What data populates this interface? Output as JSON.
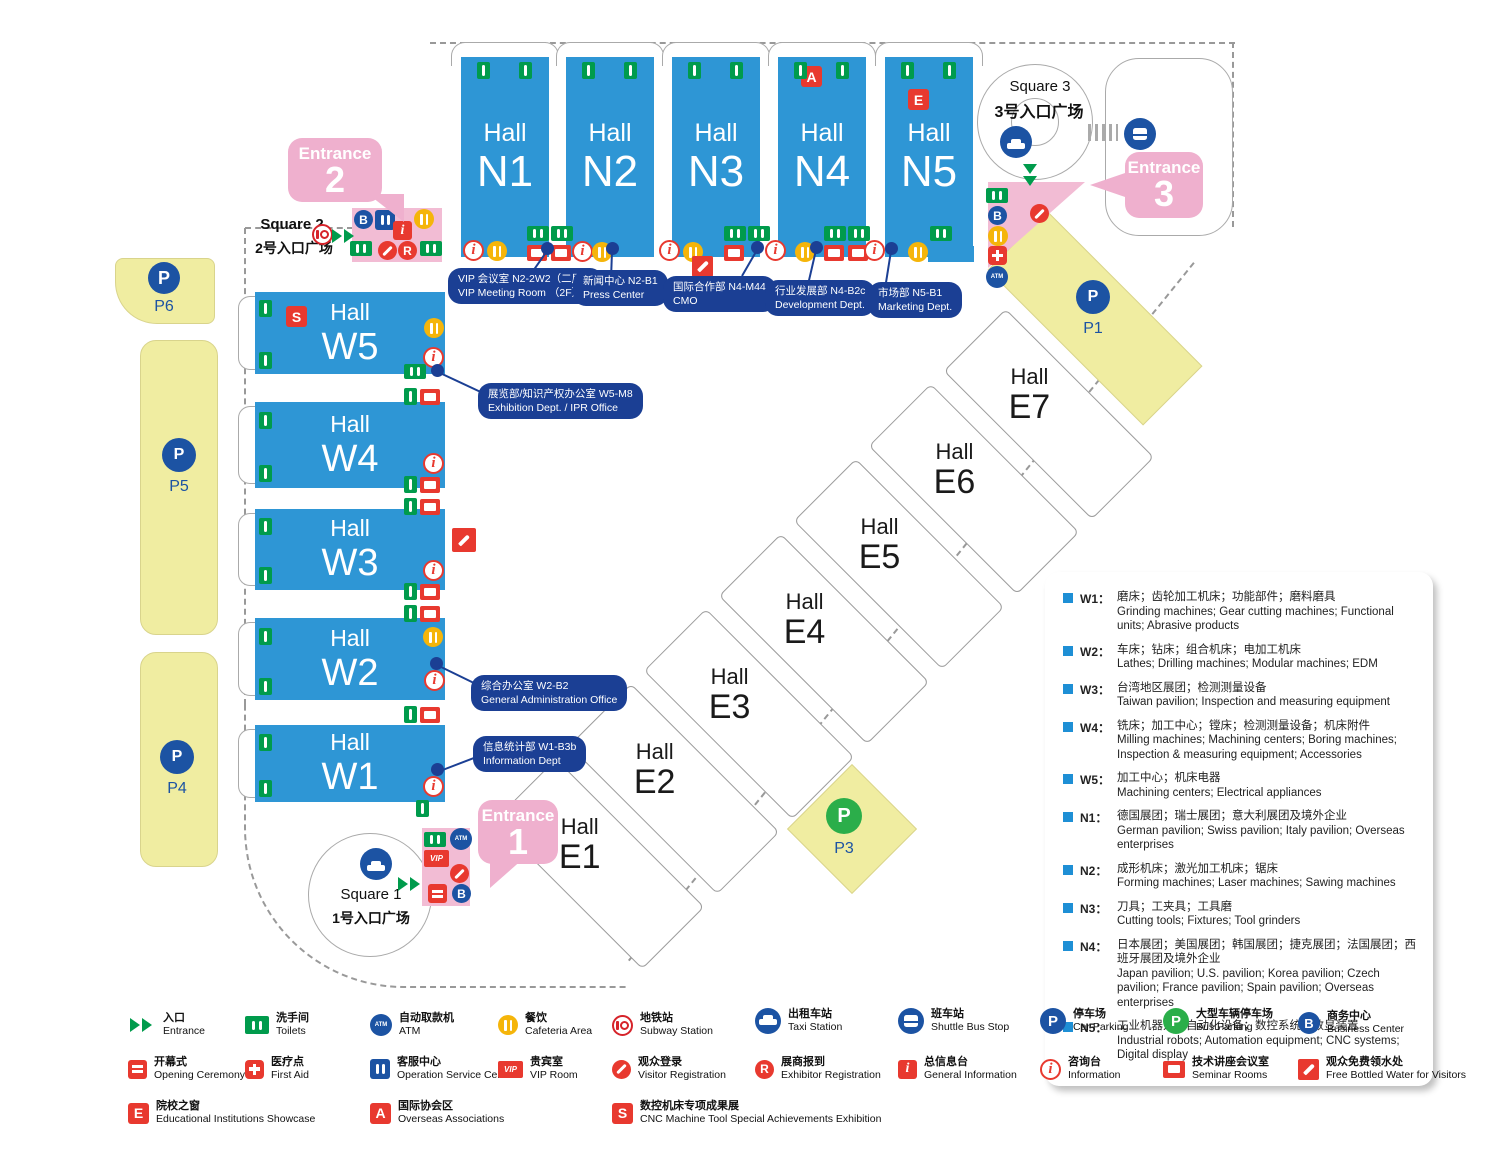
{
  "colors": {
    "hall_blue": "#2E96D5",
    "callout_navy": "#1B3F94",
    "parking_yellow": "#F0EDA1",
    "entrance_pink": "#F2BCD4",
    "accent_red": "#E8392F",
    "accent_green": "#009B4C"
  },
  "map": {
    "badges": {
      "p": "P",
      "b": "B",
      "r": "R",
      "i": "i",
      "vip": "VIP",
      "atm": "ATM",
      "e": "E",
      "a": "A",
      "s": "S"
    },
    "halls_n": [
      {
        "word": "Hall",
        "code": "N1"
      },
      {
        "word": "Hall",
        "code": "N2"
      },
      {
        "word": "Hall",
        "code": "N3"
      },
      {
        "word": "Hall",
        "code": "N4"
      },
      {
        "word": "Hall",
        "code": "N5"
      }
    ],
    "halls_w": [
      {
        "word": "Hall",
        "code": "W5"
      },
      {
        "word": "Hall",
        "code": "W4"
      },
      {
        "word": "Hall",
        "code": "W3"
      },
      {
        "word": "Hall",
        "code": "W2"
      },
      {
        "word": "Hall",
        "code": "W1"
      }
    ],
    "halls_e": [
      {
        "word": "Hall",
        "code": "E1"
      },
      {
        "word": "Hall",
        "code": "E2"
      },
      {
        "word": "Hall",
        "code": "E3"
      },
      {
        "word": "Hall",
        "code": "E4"
      },
      {
        "word": "Hall",
        "code": "E5"
      },
      {
        "word": "Hall",
        "code": "E6"
      },
      {
        "word": "Hall",
        "code": "E7"
      }
    ],
    "parking": {
      "p1": "P1",
      "p3": "P3",
      "p4": "P4",
      "p5": "P5",
      "p6": "P6"
    },
    "squares": {
      "s1": {
        "en": "Square 1",
        "zh": "1号入口广场"
      },
      "s2": {
        "en": "Square 2",
        "zh": "2号入口广场"
      },
      "s3": {
        "en": "Square 3",
        "zh": "3号入口广场"
      }
    },
    "entrances": {
      "e1": {
        "word": "Entrance",
        "num": "1"
      },
      "e2": {
        "word": "Entrance",
        "num": "2"
      },
      "e3": {
        "word": "Entrance",
        "num": "3"
      }
    },
    "callouts": {
      "vip": {
        "zh": "VIP 会议室  N2-2W2（二层）",
        "en": "VIP Meeting Room （2F）"
      },
      "press": {
        "zh": "新闻中心  N2-B1",
        "en": "Press Center"
      },
      "cmo": {
        "zh": "国际合作部  N4-M44",
        "en": "CMO"
      },
      "dev": {
        "zh": "行业发展部  N4-B2c",
        "en": "Development Dept."
      },
      "mkt": {
        "zh": "市场部  N5-B1",
        "en": "Marketing Dept."
      },
      "ipr": {
        "zh": "展览部/知识产权办公室  W5-M8",
        "en": "Exhibition Dept. / IPR Office"
      },
      "admin": {
        "zh": "综合办公室  W2-B2",
        "en": "General Administration Office"
      },
      "infodept": {
        "zh": "信息统计部  W1-B3b",
        "en": "Information Dept"
      }
    }
  },
  "legend_box": {
    "items": [
      {
        "code": "W1：",
        "zh": "磨床；齿轮加工机床；功能部件；磨料磨具",
        "en": "Grinding machines; Gear cutting machines; Functional units; Abrasive products"
      },
      {
        "code": "W2：",
        "zh": "车床；钻床；组合机床；电加工机床",
        "en": "Lathes; Drilling machines; Modular machines; EDM"
      },
      {
        "code": "W3：",
        "zh": "台湾地区展团；检测测量设备",
        "en": "Taiwan pavilion; Inspection and measuring equipment"
      },
      {
        "code": "W4：",
        "zh": "铣床；加工中心；镗床；检测测量设备；机床附件",
        "en": "Milling machines; Machining centers; Boring machines; Inspection & measuring equipment; Accessories"
      },
      {
        "code": "W5：",
        "zh": "加工中心；机床电器",
        "en": "Machining centers; Electrical appliances"
      },
      {
        "code": "N1：",
        "zh": "德国展团；瑞士展团；意大利展团及境外企业",
        "en": "German pavilion; Swiss pavilion; Italy pavilion; Overseas enterprises"
      },
      {
        "code": "N2：",
        "zh": "成形机床；激光加工机床；锯床",
        "en": "Forming machines; Laser machines; Sawing machines"
      },
      {
        "code": "N3：",
        "zh": "刀具；工夹具；工具磨",
        "en": "Cutting tools; Fixtures; Tool grinders"
      },
      {
        "code": "N4：",
        "zh": "日本展团；美国展团；韩国展团；捷克展团；法国展团；西班牙展团及境外企业",
        "en": "Japan pavilion; U.S. pavilion; Korea pavilion; Czech pavilion; France pavilion; Spain pavilion; Overseas enterprises"
      },
      {
        "code": "N5：",
        "zh": "工业机器人；自动化设备；数控系统；数显装置",
        "en": "Industrial robots; Automation equipment; CNC systems; Digital display"
      }
    ]
  },
  "legend_bottom": {
    "rows": [
      [
        {
          "icon": "entrance",
          "zh": "入口",
          "en": "Entrance"
        },
        {
          "icon": "toilets",
          "zh": "洗手间",
          "en": "Toilets"
        },
        {
          "icon": "atm",
          "zh": "自动取款机",
          "en": "ATM"
        },
        {
          "icon": "cafeteria",
          "zh": "餐饮",
          "en": "Cafeteria Area"
        },
        {
          "icon": "subway",
          "zh": "地铁站",
          "en": "Subway Station"
        },
        {
          "icon": "taxi",
          "zh": "出租车站",
          "en": "Taxi Station"
        },
        {
          "icon": "shuttle-bus",
          "zh": "班车站",
          "en": "Shuttle Bus Stop"
        },
        {
          "icon": "car-parking",
          "zh": "停车场",
          "en": "Car Parking"
        },
        {
          "icon": "bus-parking",
          "zh": "大型车辆停车场",
          "en": "Bus Parking"
        },
        {
          "icon": "business-center",
          "zh": "商务中心",
          "en": "Business Center"
        }
      ],
      [
        {
          "icon": "opening-ceremony",
          "zh": "开幕式",
          "en": "Opening Ceremony"
        },
        {
          "icon": "first-aid",
          "zh": "医疗点",
          "en": "First Aid"
        },
        {
          "icon": "operation-service",
          "zh": "客服中心",
          "en": "Operation Service Centre"
        },
        {
          "icon": "vip-room",
          "zh": "贵宾室",
          "en": "VIP Room"
        },
        {
          "icon": "visitor-registration",
          "zh": "观众登录",
          "en": "Visitor Registration"
        },
        {
          "icon": "exhibitor-registration",
          "zh": "展商报到",
          "en": "Exhibitor Registration"
        },
        {
          "icon": "general-information",
          "zh": "总信息台",
          "en": "General Information"
        },
        {
          "icon": "information",
          "zh": "咨询台",
          "en": "Information"
        },
        {
          "icon": "seminar-rooms",
          "zh": "技术讲座会议室",
          "en": "Seminar Rooms"
        },
        {
          "icon": "free-water",
          "zh": "观众免费领水处",
          "en": "Free Bottled Water for Visitors"
        }
      ],
      [
        {
          "icon": "educational",
          "zh": "院校之窗",
          "en": "Educational Institutions Showcase"
        },
        {
          "icon": "overseas-assoc",
          "zh": "国际协会区",
          "en": "Overseas Associations"
        },
        {
          "icon": "cnc-exhibition",
          "zh": "数控机床专项成果展",
          "en": "CNC Machine Tool Special Achievements Exhibition"
        }
      ]
    ]
  }
}
